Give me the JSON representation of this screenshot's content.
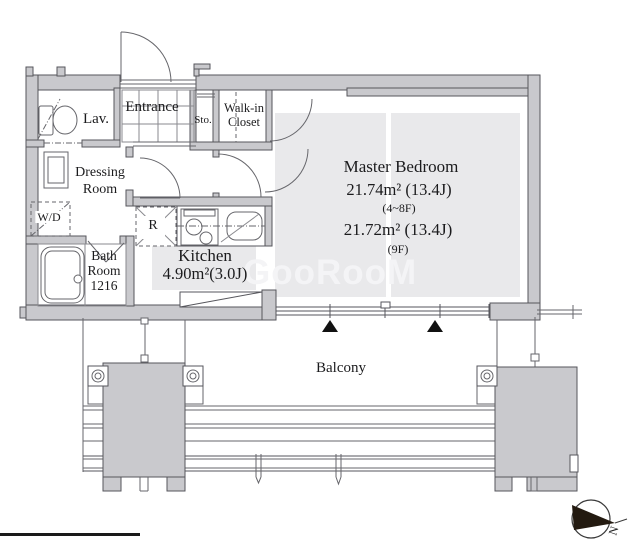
{
  "floorplan": {
    "labels": {
      "lav": "Lav.",
      "entrance": "Entrance",
      "sto": "Sto.",
      "walkin1": "Walk-in",
      "walkin2": "Closet",
      "dressing1": "Dressing",
      "dressing2": "Room",
      "wd": "W/D",
      "bath1": "Bath",
      "bath2": "Room",
      "bath3": "1216",
      "fridge": "R",
      "kitchen": "Kitchen",
      "kitchen_area": "4.90m²(3.0J)",
      "bedroom": "Master Bedroom",
      "bedroom_area1": "21.74m² (13.4J)",
      "bedroom_floors1": "(4~8F)",
      "bedroom_area2": "21.72m² (13.4J)",
      "bedroom_floors2": "(9F)",
      "balcony": "Balcony"
    },
    "compass": {
      "n": "N"
    },
    "watermark": "GooRooM",
    "colors": {
      "wall_fill": "#c9c9cd",
      "wall_stroke": "#56565c",
      "floor_fill": "#e9e9eb",
      "thin_line": "#66666b",
      "text": "#1b1b1d",
      "triangle": "#111111",
      "watermark": "#f4f4f6"
    }
  }
}
